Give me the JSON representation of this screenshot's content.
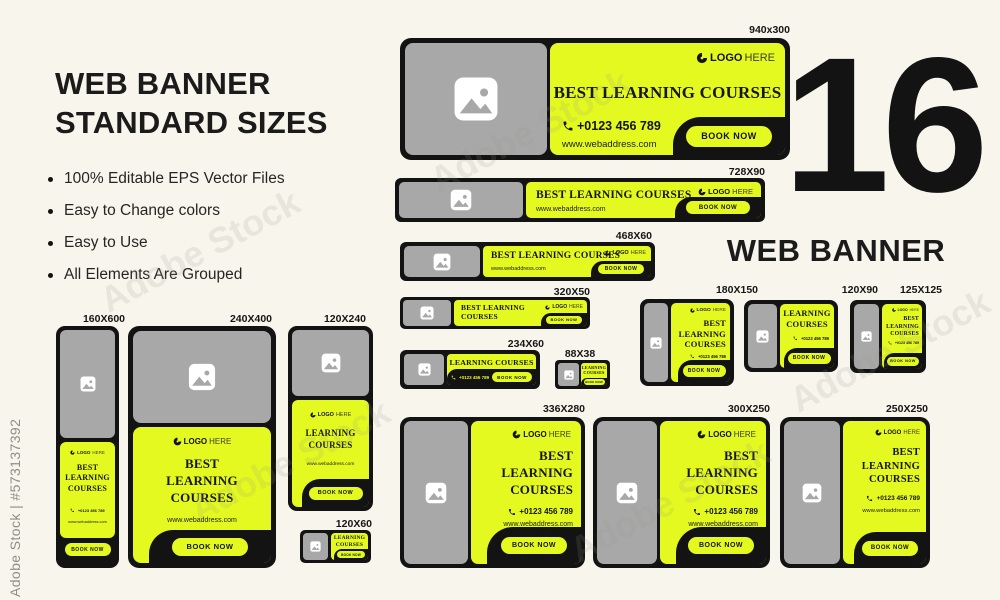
{
  "colors": {
    "accent": "#E4F91F",
    "ink": "#131313",
    "gray": "#A8A8A8",
    "cream": "#F8F5EC"
  },
  "watermark": {
    "side": "Adobe Stock | #573137392",
    "ghost": "Adobe Stock"
  },
  "intro": {
    "title1": "WEB BANNER",
    "title2": "STANDARD SIZES",
    "bullets": [
      "100% Editable EPS Vector Files",
      "Easy to Change colors",
      "Easy to Use",
      "All Elements Are Grouped"
    ]
  },
  "count": {
    "number": "16",
    "label": "WEB BANNER"
  },
  "banners": [
    {
      "label": "940x300",
      "logo": "LOGO",
      "logo2": "HERE",
      "heading": "BEST LEARNING COURSES",
      "phone": "+0123 456 789",
      "web": "www.webaddress.com",
      "cta": "BOOK NOW"
    },
    {
      "label": "728X90",
      "logo": "LOGO",
      "logo2": "HERE",
      "heading": "BEST LEARNING COURSES",
      "web": "www.webaddress.com",
      "cta": "BOOK NOW"
    },
    {
      "label": "468X60",
      "logo": "LOGO",
      "logo2": "HERE",
      "heading": "BEST LEARNING COURSES",
      "web": "www.webaddress.com",
      "cta": "BOOK NOW"
    },
    {
      "label": "320X50",
      "logo": "LOGO",
      "logo2": "HERE",
      "line1": "BEST LEARNING",
      "line2": "COURSES",
      "cta": "BOOK NOW"
    },
    {
      "label": "234X60",
      "heading": "LEARNING COURSES",
      "phone": "+0123 456 789",
      "cta": "BOOK NOW"
    },
    {
      "label": "88X38",
      "line1": "LEARNING",
      "line2": "COURSES",
      "cta": "BOOK NOW"
    },
    {
      "label": "180X150",
      "logo": "LOGO",
      "logo2": "HERE",
      "line1": "BEST",
      "line2": "LEARNING",
      "line3": "COURSES",
      "phone": "+0123 456 789",
      "cta": "BOOK NOW"
    },
    {
      "label": "120X90",
      "line1": "LEARNING",
      "line2": "COURSES",
      "phone": "+0123 456 789",
      "cta": "BOOK NOW"
    },
    {
      "label": "125X125",
      "logo": "LOGO",
      "logo2": "HERE",
      "line1": "BEST",
      "line2": "LEARNING",
      "line3": "COURSES",
      "phone": "+0123 456 789",
      "cta": "BOOK NOW"
    },
    {
      "label": "336X280",
      "logo": "LOGO",
      "logo2": "HERE",
      "line1": "BEST",
      "line2": "LEARNING",
      "line3": "COURSES",
      "phone": "+0123 456 789",
      "web": "www.webaddress.com",
      "cta": "BOOK NOW"
    },
    {
      "label": "300X250",
      "logo": "LOGO",
      "logo2": "HERE",
      "line1": "BEST",
      "line2": "LEARNING",
      "line3": "COURSES",
      "phone": "+0123 456 789",
      "web": "www.webaddress.com",
      "cta": "BOOK NOW"
    },
    {
      "label": "250X250",
      "logo": "LOGO",
      "logo2": "HERE",
      "line1": "BEST",
      "line2": "LEARNING",
      "line3": "COURSES",
      "phone": "+0123 456 789",
      "web": "www.webaddress.com",
      "cta": "BOOK NOW"
    },
    {
      "label": "160X600",
      "logo": "LOGO",
      "logo2": "HERE",
      "line1": "BEST",
      "line2": "LEARNING",
      "line3": "COURSES",
      "phone": "+0123 456 789",
      "web": "www.webaddress.com",
      "cta": "BOOK NOW"
    },
    {
      "label": "240X400",
      "logo": "LOGO",
      "logo2": "HERE",
      "line1": "BEST",
      "line2": "LEARNING",
      "line3": "COURSES",
      "web": "www.webaddress.com",
      "cta": "BOOK NOW"
    },
    {
      "label": "120X240",
      "logo": "LOGO",
      "logo2": "HERE",
      "line1": "LEARNING",
      "line2": "COURSES",
      "web": "www.webaddress.com",
      "cta": "BOOK NOW"
    },
    {
      "label": "120X60",
      "line1": "LEARNING",
      "line2": "COURSES",
      "cta": "BOOK NOW"
    }
  ]
}
